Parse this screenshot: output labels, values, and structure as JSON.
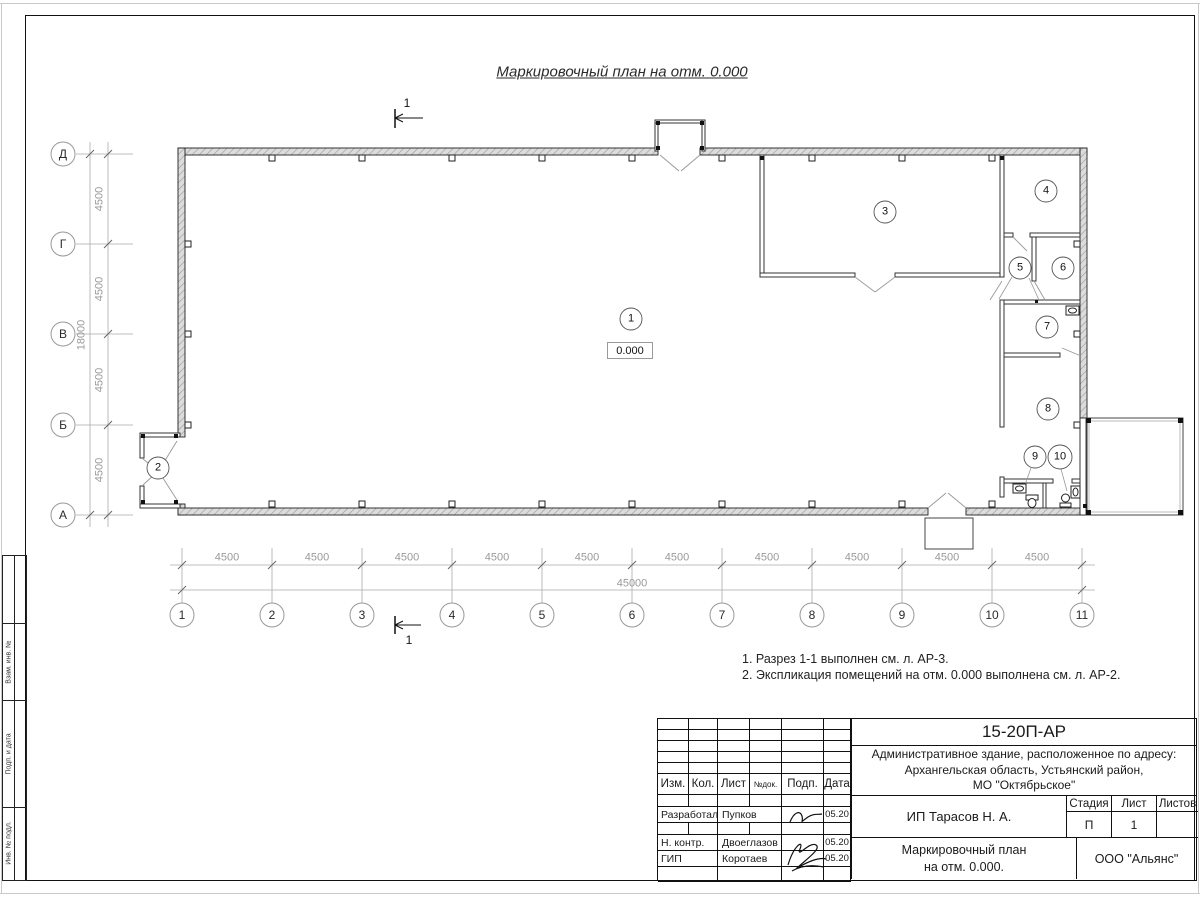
{
  "title": "Маркировочный план на отм. 0.000",
  "section_marks": {
    "top": "1",
    "bottom": "1"
  },
  "elevation": "0.000",
  "rooms": [
    "1",
    "2",
    "3",
    "4",
    "5",
    "6",
    "7",
    "8",
    "9",
    "10"
  ],
  "axes": {
    "bottom": [
      "1",
      "2",
      "3",
      "4",
      "5",
      "6",
      "7",
      "8",
      "9",
      "10",
      "11"
    ],
    "left": [
      "Д",
      "Г",
      "В",
      "Б",
      "А"
    ]
  },
  "dims": {
    "bay": "4500",
    "bottom_total": "45000",
    "left_total": "18000"
  },
  "notes": [
    "1. Разрез 1-1 выполнен см. л. АР-3.",
    "2. Экспликация помещений на отм. 0.000 выполнена см. л. АР-2."
  ],
  "margin_labels": [
    "Взам. инв. №",
    "Подп. и дата",
    "Инв. № подл."
  ],
  "titleblock": {
    "doc_number": "15-20П-АР",
    "project_line1": "Административное здание, расположенное по адресу:",
    "project_line2": "Архангельская область, Устьянский район,",
    "project_line3": "МО \"Октябрьское\"",
    "client": "ИП Тарасов Н. А.",
    "sheet_title_line1": "Маркировочный план",
    "sheet_title_line2": "на отм. 0.000.",
    "company": "ООО \"Альянс\"",
    "stage_label": "Стадия",
    "sheet_label": "Лист",
    "sheets_label": "Листов",
    "stage_value": "П",
    "sheet_value": "1",
    "sheets_value": "",
    "cols": {
      "izm": "Изм.",
      "kol": "Кол.",
      "list": "Лист",
      "ndok": "№док.",
      "podp": "Подп.",
      "data": "Дата"
    },
    "rows": [
      {
        "role": "Разработал",
        "name": "Пупков",
        "date": "05.20"
      },
      {
        "role": "Н. контр.",
        "name": "Двоеглазов",
        "date": "05.20"
      },
      {
        "role": "ГИП",
        "name": "Коротаев",
        "date": "05.20"
      }
    ]
  },
  "colors": {
    "line": "#1c1c1c",
    "dim": "#9a9a9a",
    "wall_hatch_bg": "#dcdcdc"
  }
}
